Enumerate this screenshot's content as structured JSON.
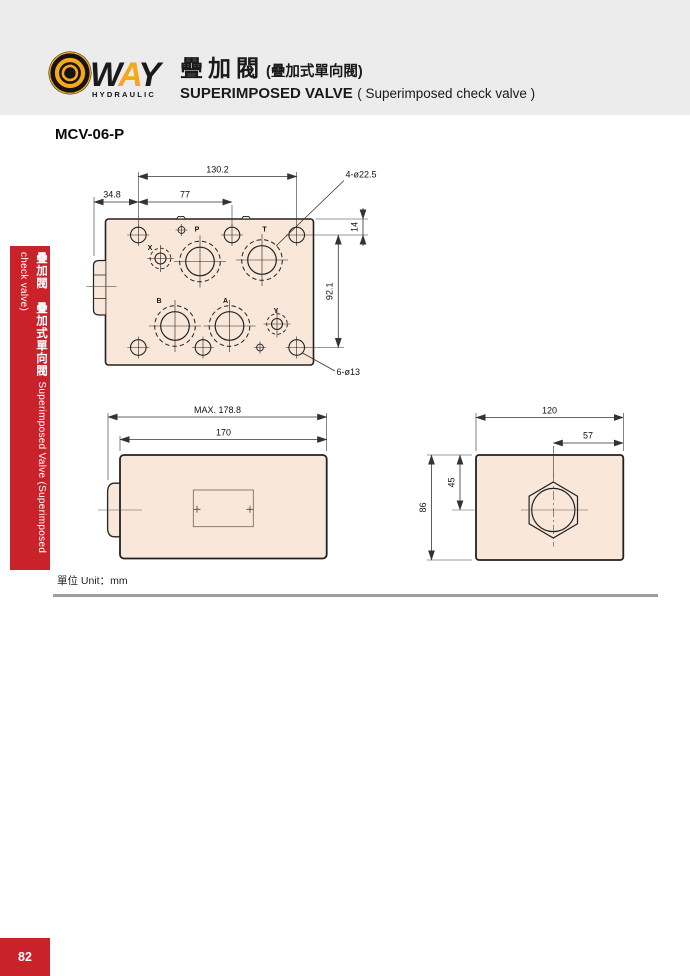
{
  "header": {
    "brand_letters": [
      "W",
      "A",
      "Y"
    ],
    "brand_sub": "HYDRAULIC",
    "title_zh": "疊加閥",
    "title_zh_paren": "(疊加式單向閥)",
    "title_en": "SUPERIMPOSED VALVE",
    "title_en_paren": "( Superimposed check valve )"
  },
  "model": "MCV-06-P",
  "sidebar": {
    "label_zh": "疊加閥　疊加式單向閥",
    "label_en": "Superimposed Valve (Superimposed check valve)"
  },
  "drawings": {
    "unit_label": "單位 Unit：mm",
    "top_view": {
      "ports": [
        "X",
        "P",
        "T",
        "B",
        "A",
        "Y"
      ],
      "dim_hole_span_width": "130.2",
      "dim_left_offset": "34.8",
      "dim_mid_hole_offset": "77",
      "dim_top_edge_to_holes": "14",
      "dim_hole_span_height": "92.1",
      "callout_large_holes": "4-ø22.5",
      "callout_small_holes": "6-ø13"
    },
    "side_view": {
      "dim_max_length": "MAX. 178.8",
      "dim_body_length": "170"
    },
    "end_view": {
      "dim_width": "120",
      "dim_plug_offset": "57",
      "dim_height": "86",
      "dim_plug_center_height": "45"
    }
  },
  "page_number": "82",
  "colors": {
    "accent_red": "#c9222b",
    "brand_yellow": "#f5a81c",
    "drawing_fill": "#f9e8da",
    "header_bg": "#ececec",
    "line": "#222222",
    "divider_gray": "#9c9c9c"
  }
}
